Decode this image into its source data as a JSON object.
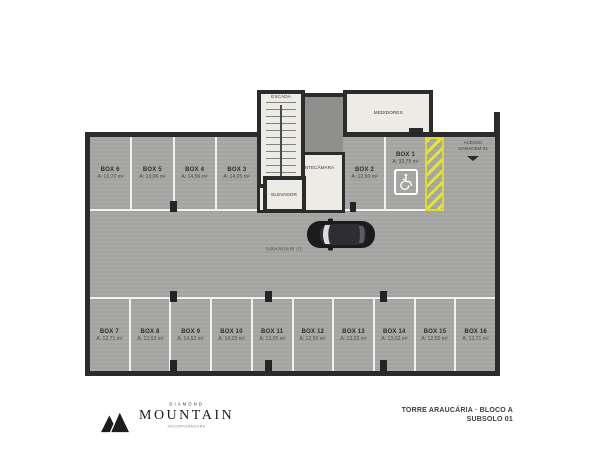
{
  "plan": {
    "rooms": {
      "escada": "ESCADA",
      "antecamara": "ANTECÂMARA",
      "elevador": "ELEVADOR",
      "medidores": "MEDIDORES"
    },
    "labels": {
      "garage": "GARAGEM 01",
      "access_line1": "ACESSO",
      "access_line2": "GARAGEM 01"
    },
    "boxes_top": [
      {
        "label": "BOX 6",
        "area": "A: 12,72 m²"
      },
      {
        "label": "BOX 5",
        "area": "A: 13,06 m²"
      },
      {
        "label": "BOX 4",
        "area": "A: 14,56 m²"
      },
      {
        "label": "BOX 3",
        "area": "A: 14,25 m²"
      },
      {
        "label": "BOX 2",
        "area": "A: 12,50 m²"
      },
      {
        "label": "BOX 1",
        "area": "A: 33,75 m²",
        "accessible": true
      }
    ],
    "boxes_bottom": [
      {
        "label": "BOX 7",
        "area": "A: 12,71 m²"
      },
      {
        "label": "BOX 8",
        "area": "A: 13,03 m²"
      },
      {
        "label": "BOX 9",
        "area": "A: 14,52 m²"
      },
      {
        "label": "BOX 10",
        "area": "A: 14,25 m²"
      },
      {
        "label": "BOX 11",
        "area": "A: 13,05 m²"
      },
      {
        "label": "BOX 12",
        "area": "A: 12,50 m²"
      },
      {
        "label": "BOX 13",
        "area": "A: 13,03 m²"
      },
      {
        "label": "BOX 14",
        "area": "A: 13,02 m²"
      },
      {
        "label": "BOX 15",
        "area": "A: 12,50 m²"
      },
      {
        "label": "BOX 16",
        "area": "A: 13,71 m²"
      }
    ]
  },
  "footer": {
    "brand": {
      "top": "DIAMOND",
      "name": "MOUNTAIN",
      "tagline": "INCORPORADORA"
    },
    "sheet": {
      "project": "TORRE ARAUCÁRIA · BLOCO A",
      "level": "SUBSOLO 01"
    }
  },
  "colors": {
    "floor": "#a7a7a5",
    "wall": "#2b2b2b",
    "room": "#ecebe6",
    "ramp_yellow": "#e4e432",
    "stall_line": "#ffffff",
    "car": "#1b1b1e"
  }
}
